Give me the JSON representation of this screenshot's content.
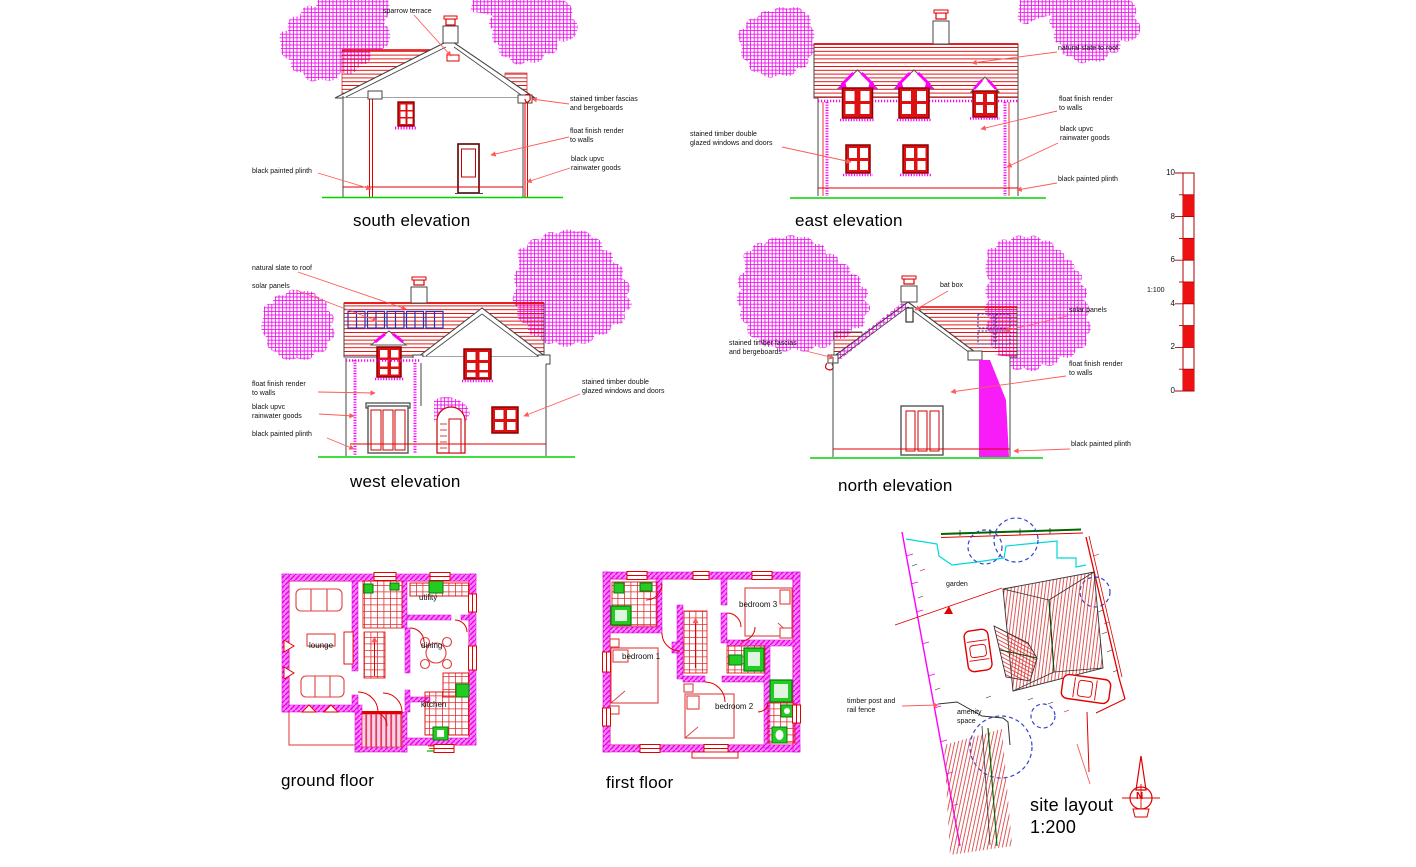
{
  "colors": {
    "magenta": "#ff00ff",
    "red": "#ee0000",
    "dark_red": "#8b0000",
    "ground_green": "#00d400",
    "fixture_green": "#22cc22",
    "solar_blue": "#2233bb",
    "tree_circle_blue": "#3344cc",
    "cyan": "#00d8d8",
    "site_green": "#006600"
  },
  "south_elevation": {
    "title": "south elevation",
    "labels": {
      "sparrow_terrace": "sparrow terrace",
      "fascias_line1": "stained timber fascias",
      "fascias_line2": "and bergeboards",
      "render_line1": "float finish render",
      "render_line2": "to walls",
      "rainwater_line1": "black upvc",
      "rainwater_line2": "rainwater goods",
      "plinth": "black painted plinth"
    }
  },
  "east_elevation": {
    "title": "east elevation",
    "labels": {
      "slate": "natural slate to roof",
      "render_line1": "float finish render",
      "render_line2": "to walls",
      "rainwater_line1": "black upvc",
      "rainwater_line2": "rainwater goods",
      "plinth": "black painted plinth",
      "windows_line1": "stained timber double",
      "windows_line2": "glazed windows and doors"
    }
  },
  "west_elevation": {
    "title": "west elevation",
    "labels": {
      "slate": "natural slate to roof",
      "solar": "solar panels",
      "render_line1": "float finish render",
      "render_line2": "to walls",
      "rainwater_line1": "black upvc",
      "rainwater_line2": "rainwater goods",
      "plinth": "black painted plinth",
      "windows_line1": "stained timber double",
      "windows_line2": "glazed windows and doors"
    }
  },
  "north_elevation": {
    "title": "north elevation",
    "labels": {
      "fascias_line1": "stained timber fascias",
      "fascias_line2": "and bergeboards",
      "bat_box": "bat box",
      "solar": "solar panels",
      "render_line1": "float finish render",
      "render_line2": "to walls",
      "plinth": "black painted plinth"
    }
  },
  "scale_bar": {
    "ratio": "1:100",
    "tick_labels": [
      "10",
      "8",
      "6",
      "4",
      "2",
      "0"
    ]
  },
  "ground_floor": {
    "title": "ground floor",
    "rooms": {
      "lounge": "lounge",
      "utility": "utility",
      "dining": "dining",
      "kitchen": "kitchen"
    }
  },
  "first_floor": {
    "title": "first floor",
    "rooms": {
      "bedroom1": "bedroom 1",
      "bedroom2": "bedroom 2",
      "bedroom3": "bedroom 3"
    }
  },
  "site_layout": {
    "title": "site layout",
    "scale": "1:200",
    "labels": {
      "garden": "garden",
      "amenity_line1": "amenity",
      "amenity_line2": "space",
      "fence_line1": "timber post and",
      "fence_line2": "rail fence",
      "north": "N"
    }
  }
}
